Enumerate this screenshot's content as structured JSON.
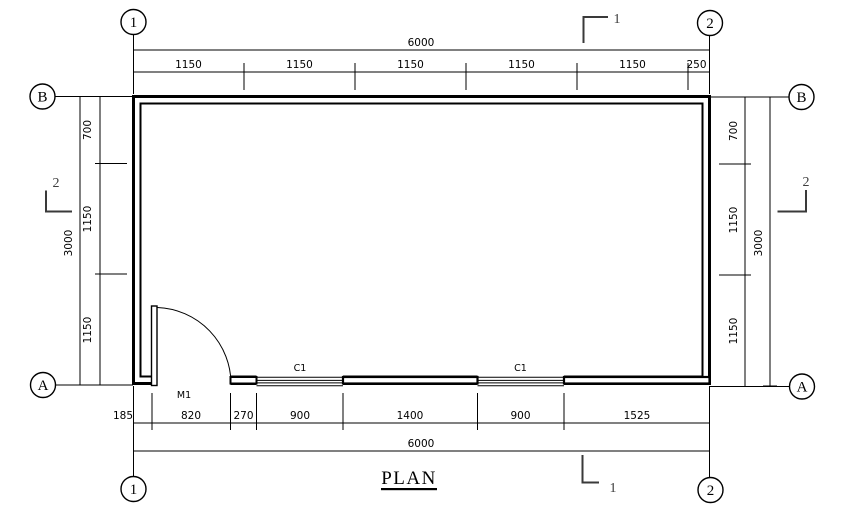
{
  "drawing": {
    "title": "PLAN",
    "labels": {
      "door": "M1",
      "window": "C1"
    },
    "grid_markers": {
      "col1": "1",
      "col2": "2",
      "rowA": "A",
      "rowB": "B"
    },
    "section_markers": {
      "s1": "1",
      "s2": "2"
    },
    "dimensions": {
      "top": {
        "total": "6000",
        "segments": [
          "1150",
          "1150",
          "1150",
          "1150",
          "1150",
          "250"
        ]
      },
      "bottom": {
        "total": "6000",
        "segments": [
          "185",
          "820",
          "270",
          "900",
          "1400",
          "900",
          "1525"
        ]
      },
      "left": {
        "total": "3000",
        "segments": [
          "700",
          "1150",
          "1150"
        ]
      },
      "right": {
        "total": "3000",
        "segments": [
          "700",
          "1150",
          "1150"
        ]
      }
    },
    "colors": {
      "line": "#000000",
      "background": "#ffffff",
      "section_marker": "#3a3a3a"
    }
  }
}
